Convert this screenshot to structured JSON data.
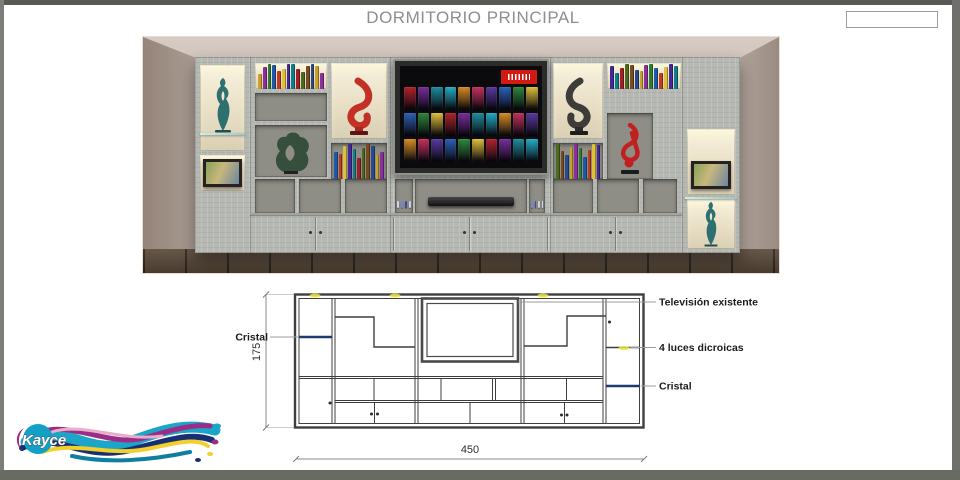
{
  "page": {
    "title": "DORMITORIO PRINCIPAL"
  },
  "reference_box": {
    "value": ""
  },
  "drawing": {
    "labels": {
      "cristal_left": "Cristal",
      "television": "Televisión existente",
      "luces": "4 luces dicroicas",
      "cristal_right": "Cristal"
    },
    "dimensions": {
      "height_cm": "175",
      "width_cm": "450"
    },
    "colors": {
      "glass_shelf": "#1e3a6e",
      "light_marker": "#e9e435",
      "outline": "#3f3f3f"
    }
  },
  "render": {
    "icons": {
      "tv_badge": "netflix-logo"
    },
    "palettes": {
      "books": [
        "#c8a22a",
        "#8a2f9e",
        "#2e7d34",
        "#1e58a8",
        "#c23a1f",
        "#e0c23a",
        "#45289a",
        "#0e7f8f",
        "#a31d2a",
        "#4a6b1f",
        "#7a4a22",
        "#274b8f"
      ],
      "posters": [
        "#b3242c",
        "#2c62b8",
        "#d88f23",
        "#7a2f9e",
        "#2f8a3c",
        "#c7325f",
        "#1f8f9e",
        "#e0c23a",
        "#5a3a9e",
        "#23b0c9"
      ],
      "trinkets": [
        "#d0d4e8",
        "#7a86c8",
        "#3a4a9e",
        "#c8cfe0"
      ]
    }
  },
  "logo": {
    "brand": "Kayce"
  }
}
